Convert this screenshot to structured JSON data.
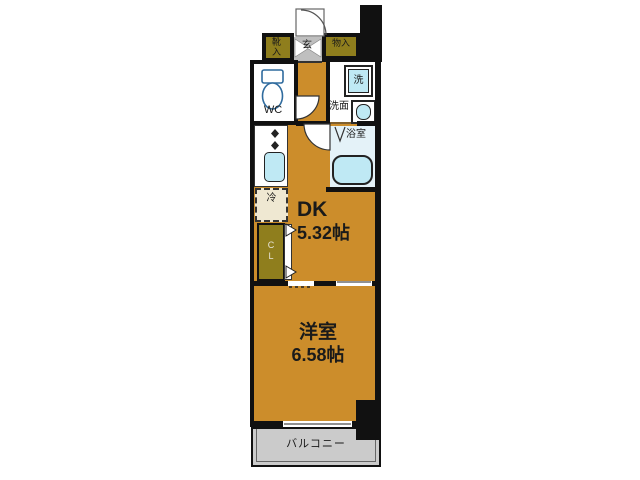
{
  "plan": {
    "entrance": {
      "label": "玄"
    },
    "shoe_cabinet": {
      "label": "靴入"
    },
    "storage": {
      "label": "物入"
    },
    "toilet_room": {
      "label": "WC"
    },
    "washer": {
      "label": "洗"
    },
    "washroom": {
      "label": "洗面"
    },
    "bathroom": {
      "label": "浴室"
    },
    "refrigerator_space": {
      "label": "冷"
    },
    "closet": {
      "label": "CL"
    },
    "dining_kitchen": {
      "name": "DK",
      "size": "5.32帖"
    },
    "western_room": {
      "name": "洋室",
      "size": "6.58帖"
    },
    "balcony": {
      "label": "バルコニー"
    }
  },
  "colors": {
    "room_fill": "#CC8D2B",
    "cabinet_fill": "#8F7E1D",
    "fixture_fill": "#BFE9F4",
    "bathroom_fill": "#E4F2F8",
    "entrance_fill": "#BFBFBF",
    "balcony_fill": "#CBCBCB",
    "refrigerator_fill": "#EFE8D2",
    "wall": "#111111"
  }
}
